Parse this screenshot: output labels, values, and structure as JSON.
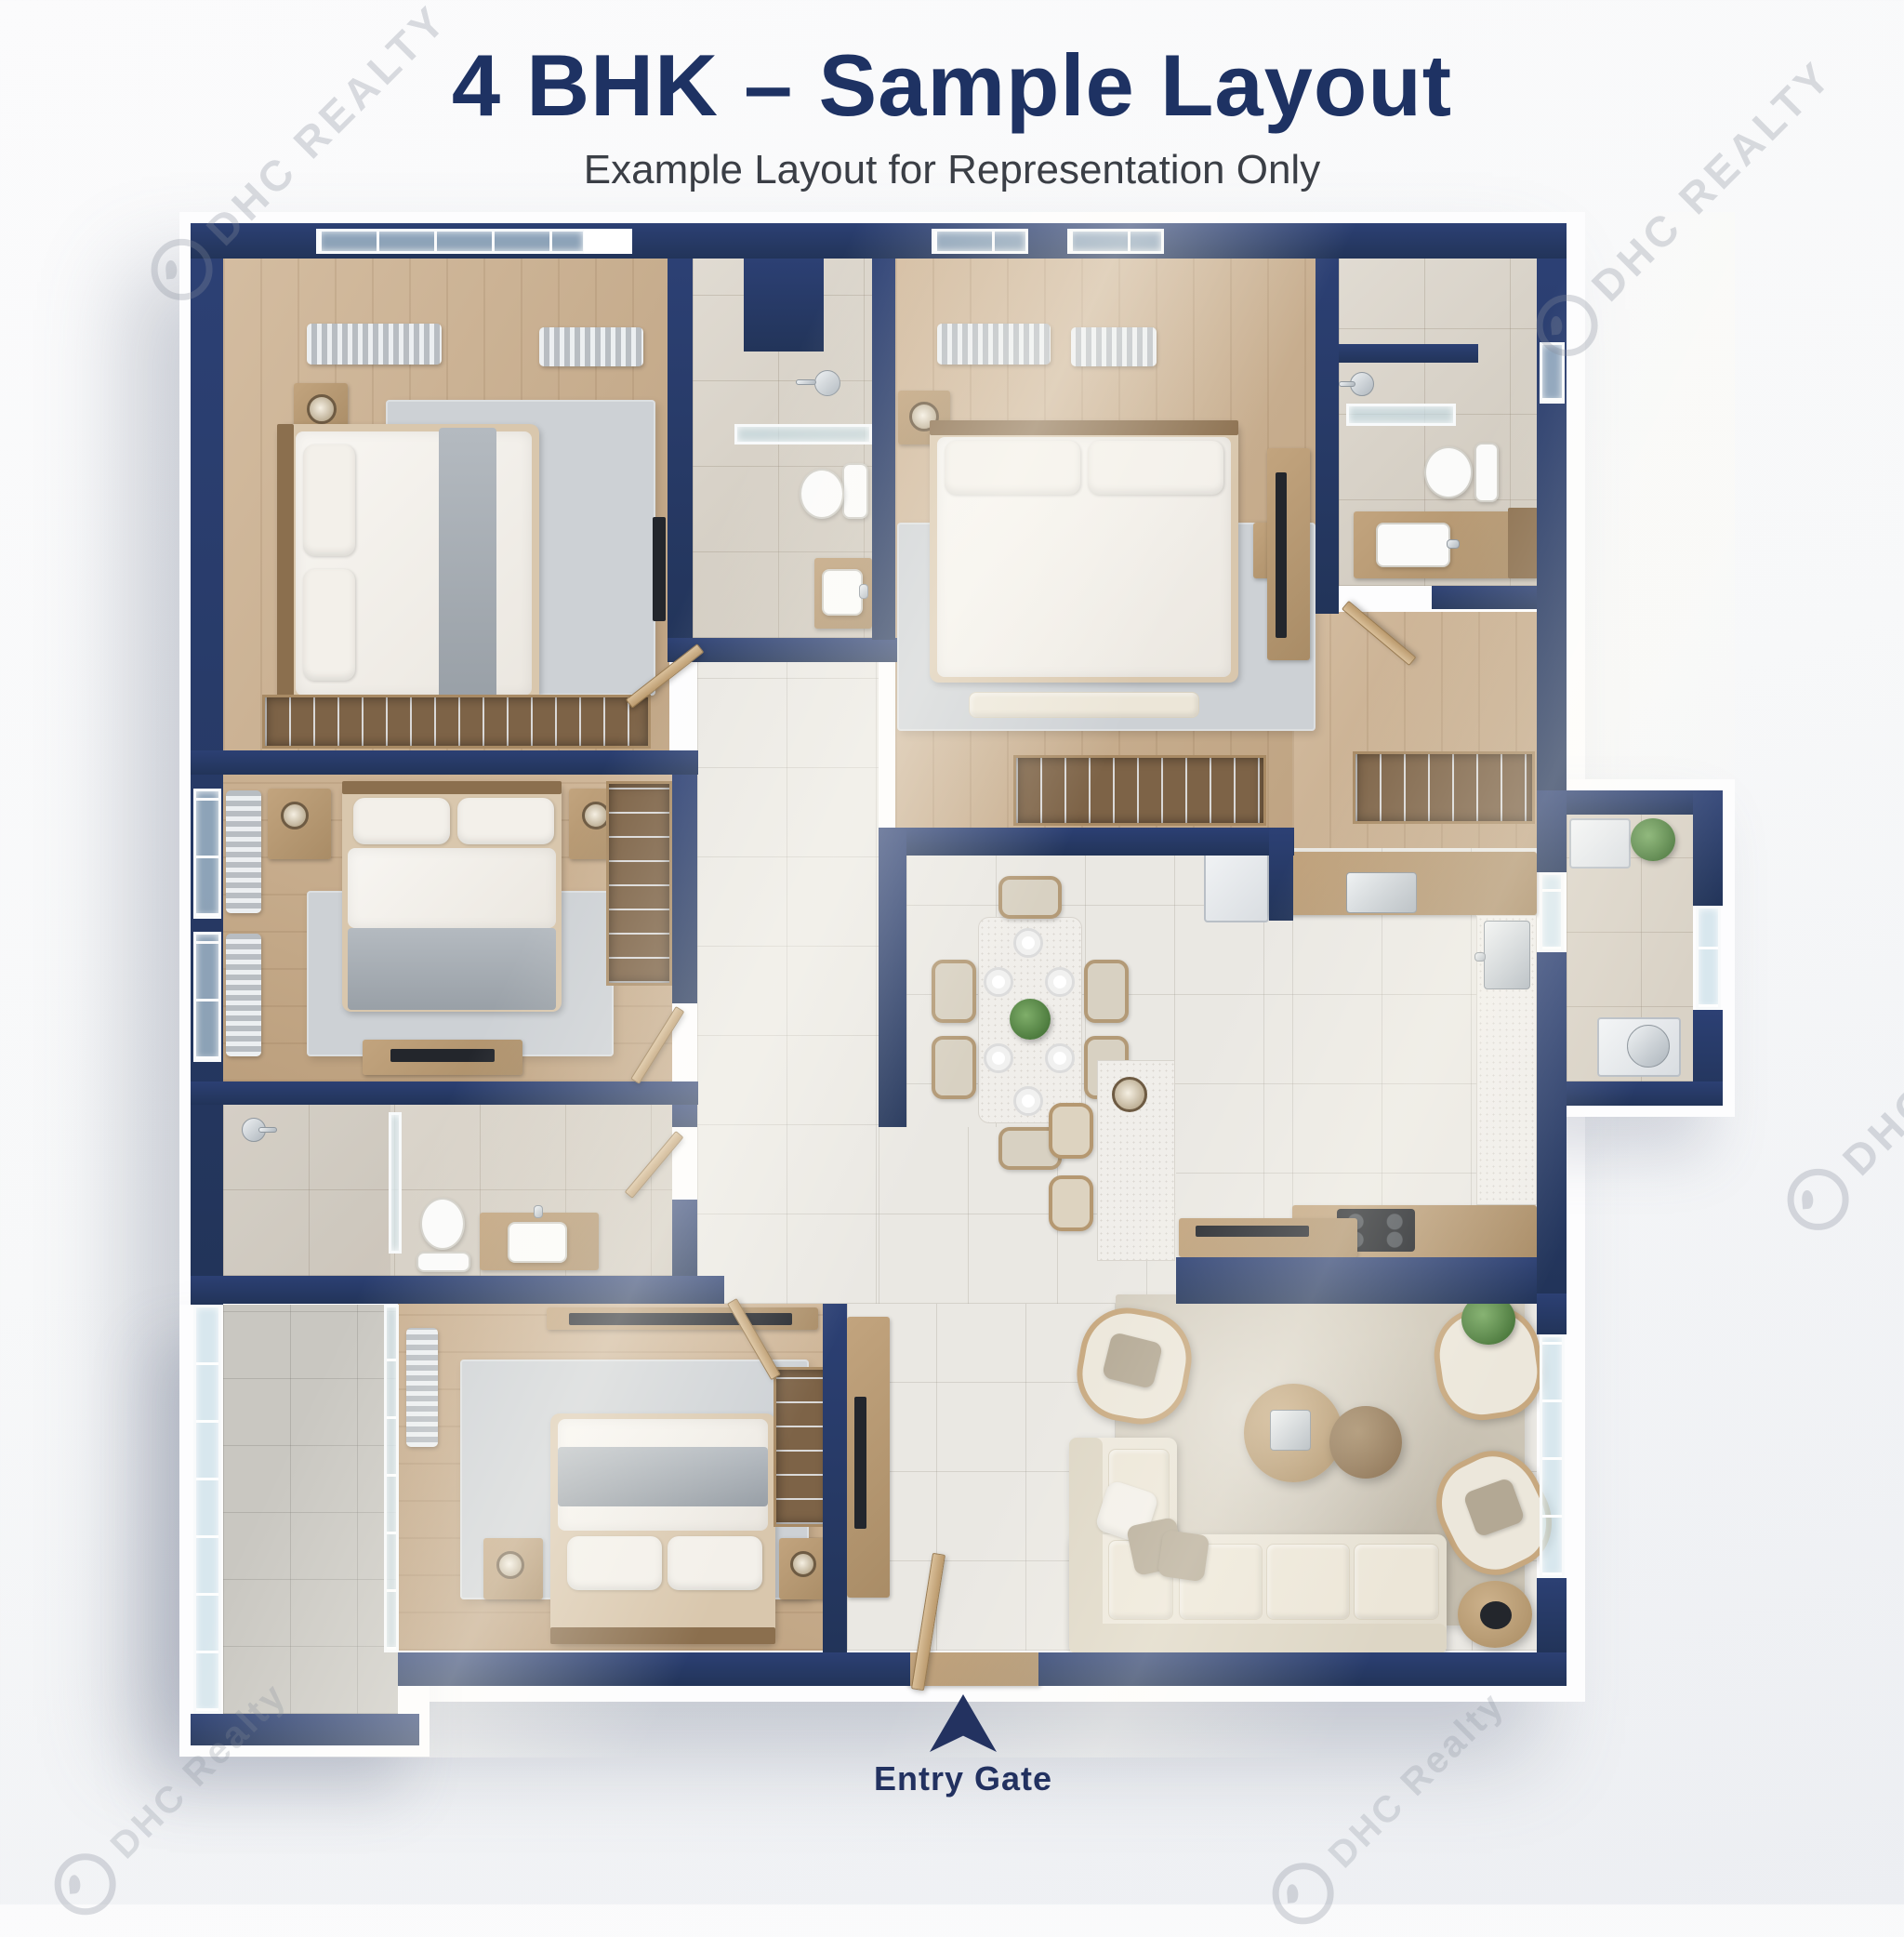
{
  "header": {
    "title": "4 BHK – Sample Layout",
    "subtitle": "Example Layout for Representation Only",
    "title_color": "#1e3263",
    "subtitle_color": "#3b3f46"
  },
  "entry": {
    "label": "Entry Gate",
    "arrow_color": "#233260"
  },
  "watermark": {
    "text": "DHC REALTY",
    "text_mixed": "DHC Realty"
  },
  "palette": {
    "wall_navy": "#273a68",
    "wood_floor": "#c9ac89",
    "tile_light": "#eae8e3",
    "tile_bath": "#d6cfc3",
    "tile_balcony": "#c9c7c1",
    "tile_utility": "#d9d2c6",
    "rug_gray": "#cdd1d5",
    "rug_beige": "#cfc8b9",
    "sofa_cream": "#ece7db",
    "counter_wood": "#c2a47e",
    "glass": "#c4dce5",
    "background": "#f7f8f9"
  },
  "rooms": [
    "bedroom-1",
    "bathroom-1",
    "master-bedroom",
    "bathroom-2",
    "bedroom-3",
    "bathroom-3",
    "bedroom-4",
    "balcony",
    "utility-balcony",
    "kitchen",
    "dining-area",
    "living-room",
    "foyer",
    "corridor",
    "dressing-area"
  ]
}
